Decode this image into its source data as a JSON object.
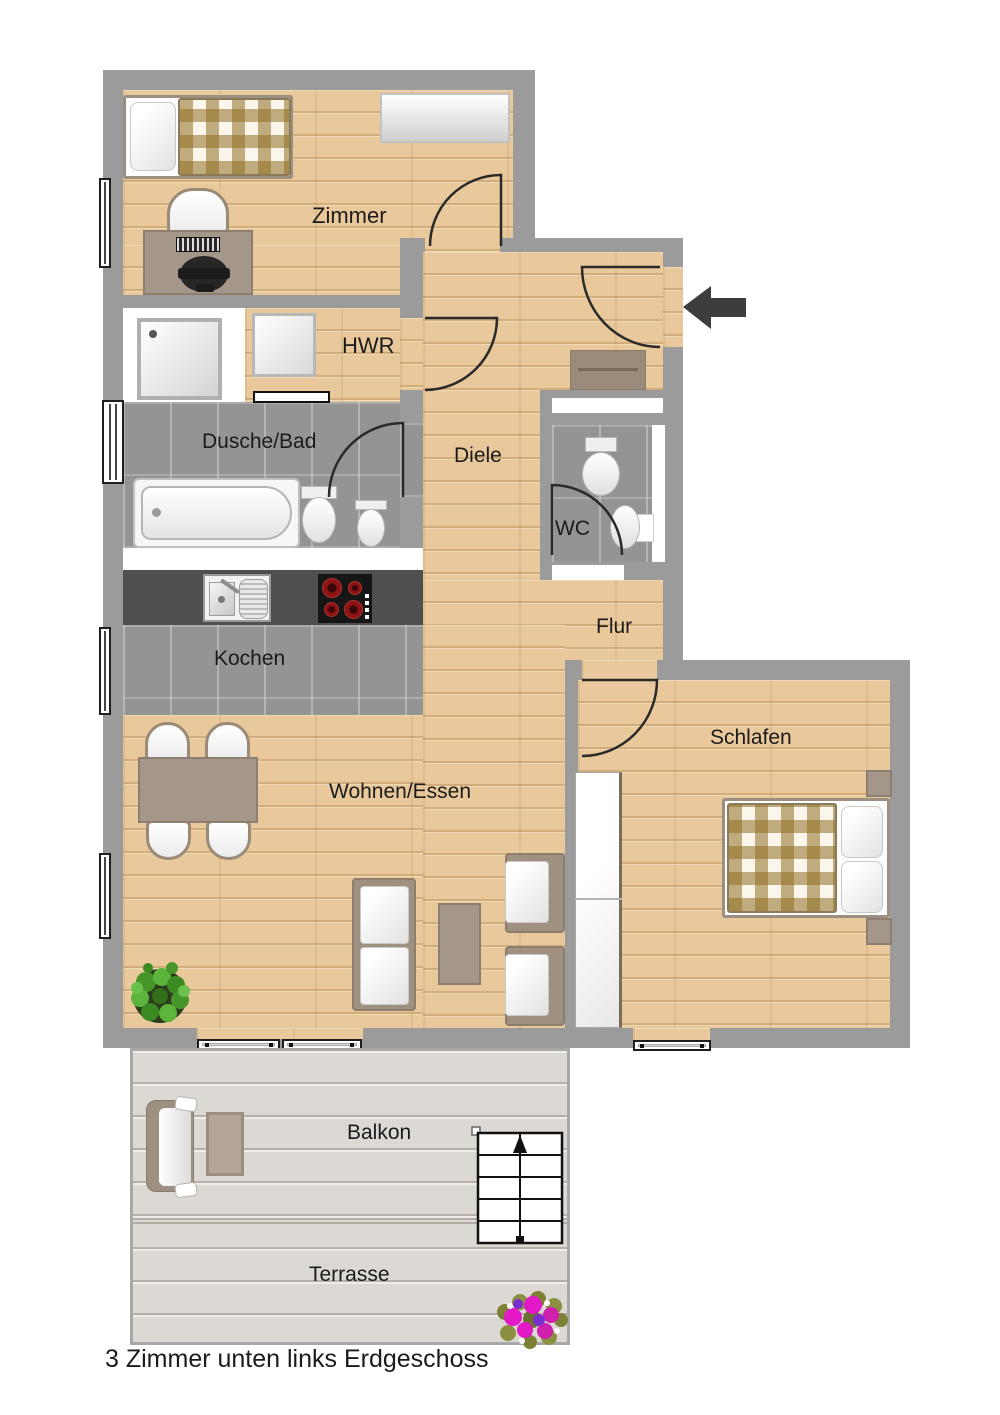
{
  "caption": "3 Zimmer unten links Erdgeschoss",
  "rooms": {
    "zimmer": "Zimmer",
    "hwr": "HWR",
    "dusche_bad": "Dusche/Bad",
    "diele": "Diele",
    "wc": "WC",
    "flur": "Flur",
    "kochen": "Kochen",
    "wohnen_essen": "Wohnen/Essen",
    "schlafen": "Schlafen",
    "balkon": "Balkon",
    "terrasse": "Terrasse"
  },
  "colors": {
    "wall": "#9b9b9b",
    "wood_base": "#e9c99b",
    "tile_base": "#949494",
    "deck_base": "#dcd8d3",
    "counter": "#4f4f4f",
    "stove": "#161616",
    "burner": "#8d1414",
    "furniture_brown": "#a5968a",
    "furniture_border": "#8e7e6f",
    "blanket_brown": "#8f6e23",
    "door_stroke": "#2a2a2a",
    "arrow": "#3d3d3d",
    "text": "#1b1b1b",
    "plant_green": "#4c9a2a",
    "flower_magenta": "#e318c6"
  },
  "icons": {
    "entrance_arrow": "entrance-direction-arrow",
    "stairs": "stairs-up",
    "plant": "potted-plant",
    "flowers": "flower-bush"
  }
}
